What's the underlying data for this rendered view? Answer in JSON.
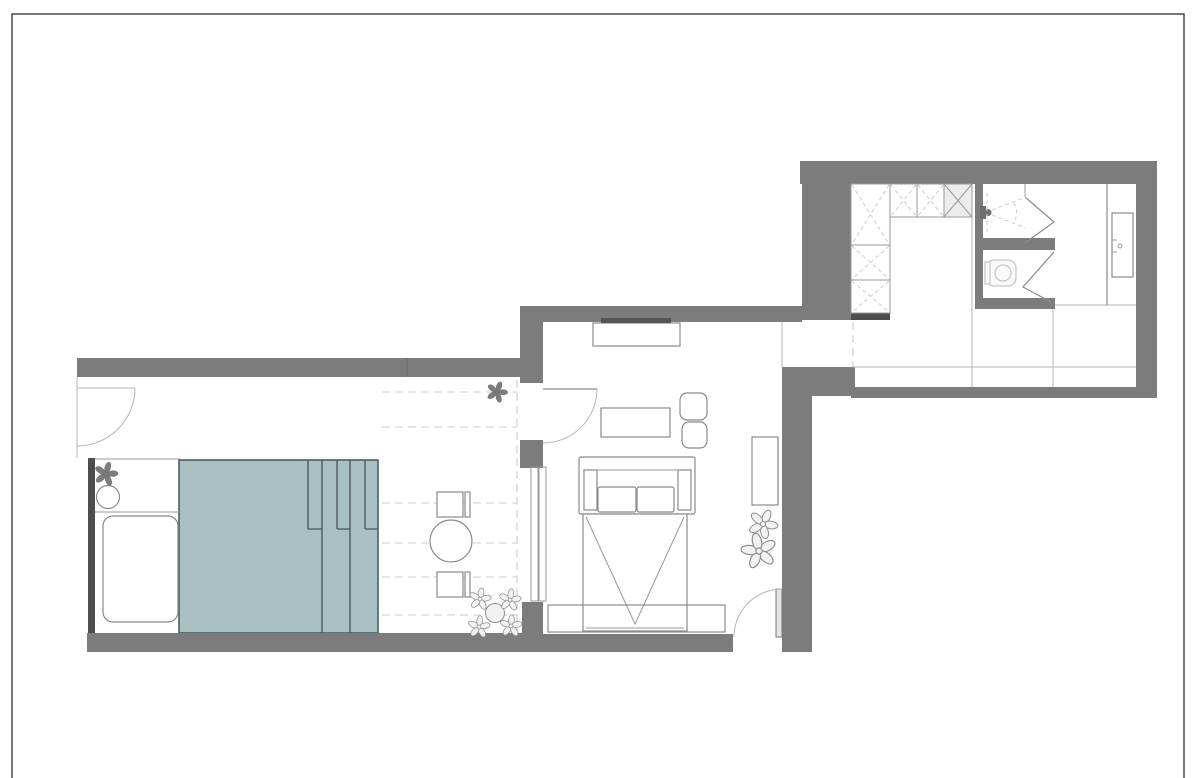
{
  "document": {
    "kind": "apartment floor plan",
    "visible_text": []
  },
  "colors": {
    "wall": "#7c7c7c",
    "wall_dark": "#4d4d4d",
    "pool_fill": "#a9c0c2",
    "pool_border": "#47555b",
    "line": "#8a8a8a",
    "line_light": "#b5b5b5",
    "dash": "#cccccc",
    "fixture_light": "#c6c6c6",
    "page_border": "#4a4a4a",
    "tv": "#555555",
    "background": "#ffffff"
  },
  "rooms": [
    {
      "name": "terrace-pool-area"
    },
    {
      "name": "living-room"
    },
    {
      "name": "entry-passage"
    },
    {
      "name": "walk-in-closet"
    },
    {
      "name": "shower-cabin"
    },
    {
      "name": "wc-compartment"
    },
    {
      "name": "bathroom"
    }
  ],
  "furniture": [
    {
      "name": "pool",
      "room": "terrace-pool-area"
    },
    {
      "name": "pool-steps",
      "room": "terrace-pool-area"
    },
    {
      "name": "lounger",
      "room": "terrace-pool-area"
    },
    {
      "name": "side-table-round",
      "room": "terrace-pool-area"
    },
    {
      "name": "bistro-table",
      "room": "terrace-pool-area"
    },
    {
      "name": "bistro-chair",
      "room": "terrace-pool-area",
      "count": 2
    },
    {
      "name": "sideboard-tv",
      "room": "living-room"
    },
    {
      "name": "coffee-table",
      "room": "living-room"
    },
    {
      "name": "pouf",
      "room": "living-room",
      "count": 2
    },
    {
      "name": "sofa",
      "room": "living-room"
    },
    {
      "name": "bed-rug",
      "room": "living-room"
    },
    {
      "name": "low-bench",
      "room": "living-room"
    },
    {
      "name": "shelf-unit",
      "room": "living-room"
    },
    {
      "name": "wardrobe-cabinets",
      "room": "walk-in-closet"
    },
    {
      "name": "shower-head",
      "room": "shower-cabin"
    },
    {
      "name": "toilet",
      "room": "wc-compartment"
    },
    {
      "name": "vanity-basin",
      "room": "bathroom"
    }
  ],
  "icons": [
    "plant-icon",
    "shower-head-icon",
    "toilet-icon",
    "door-swing-arc-icon",
    "window-glazing-icon"
  ]
}
